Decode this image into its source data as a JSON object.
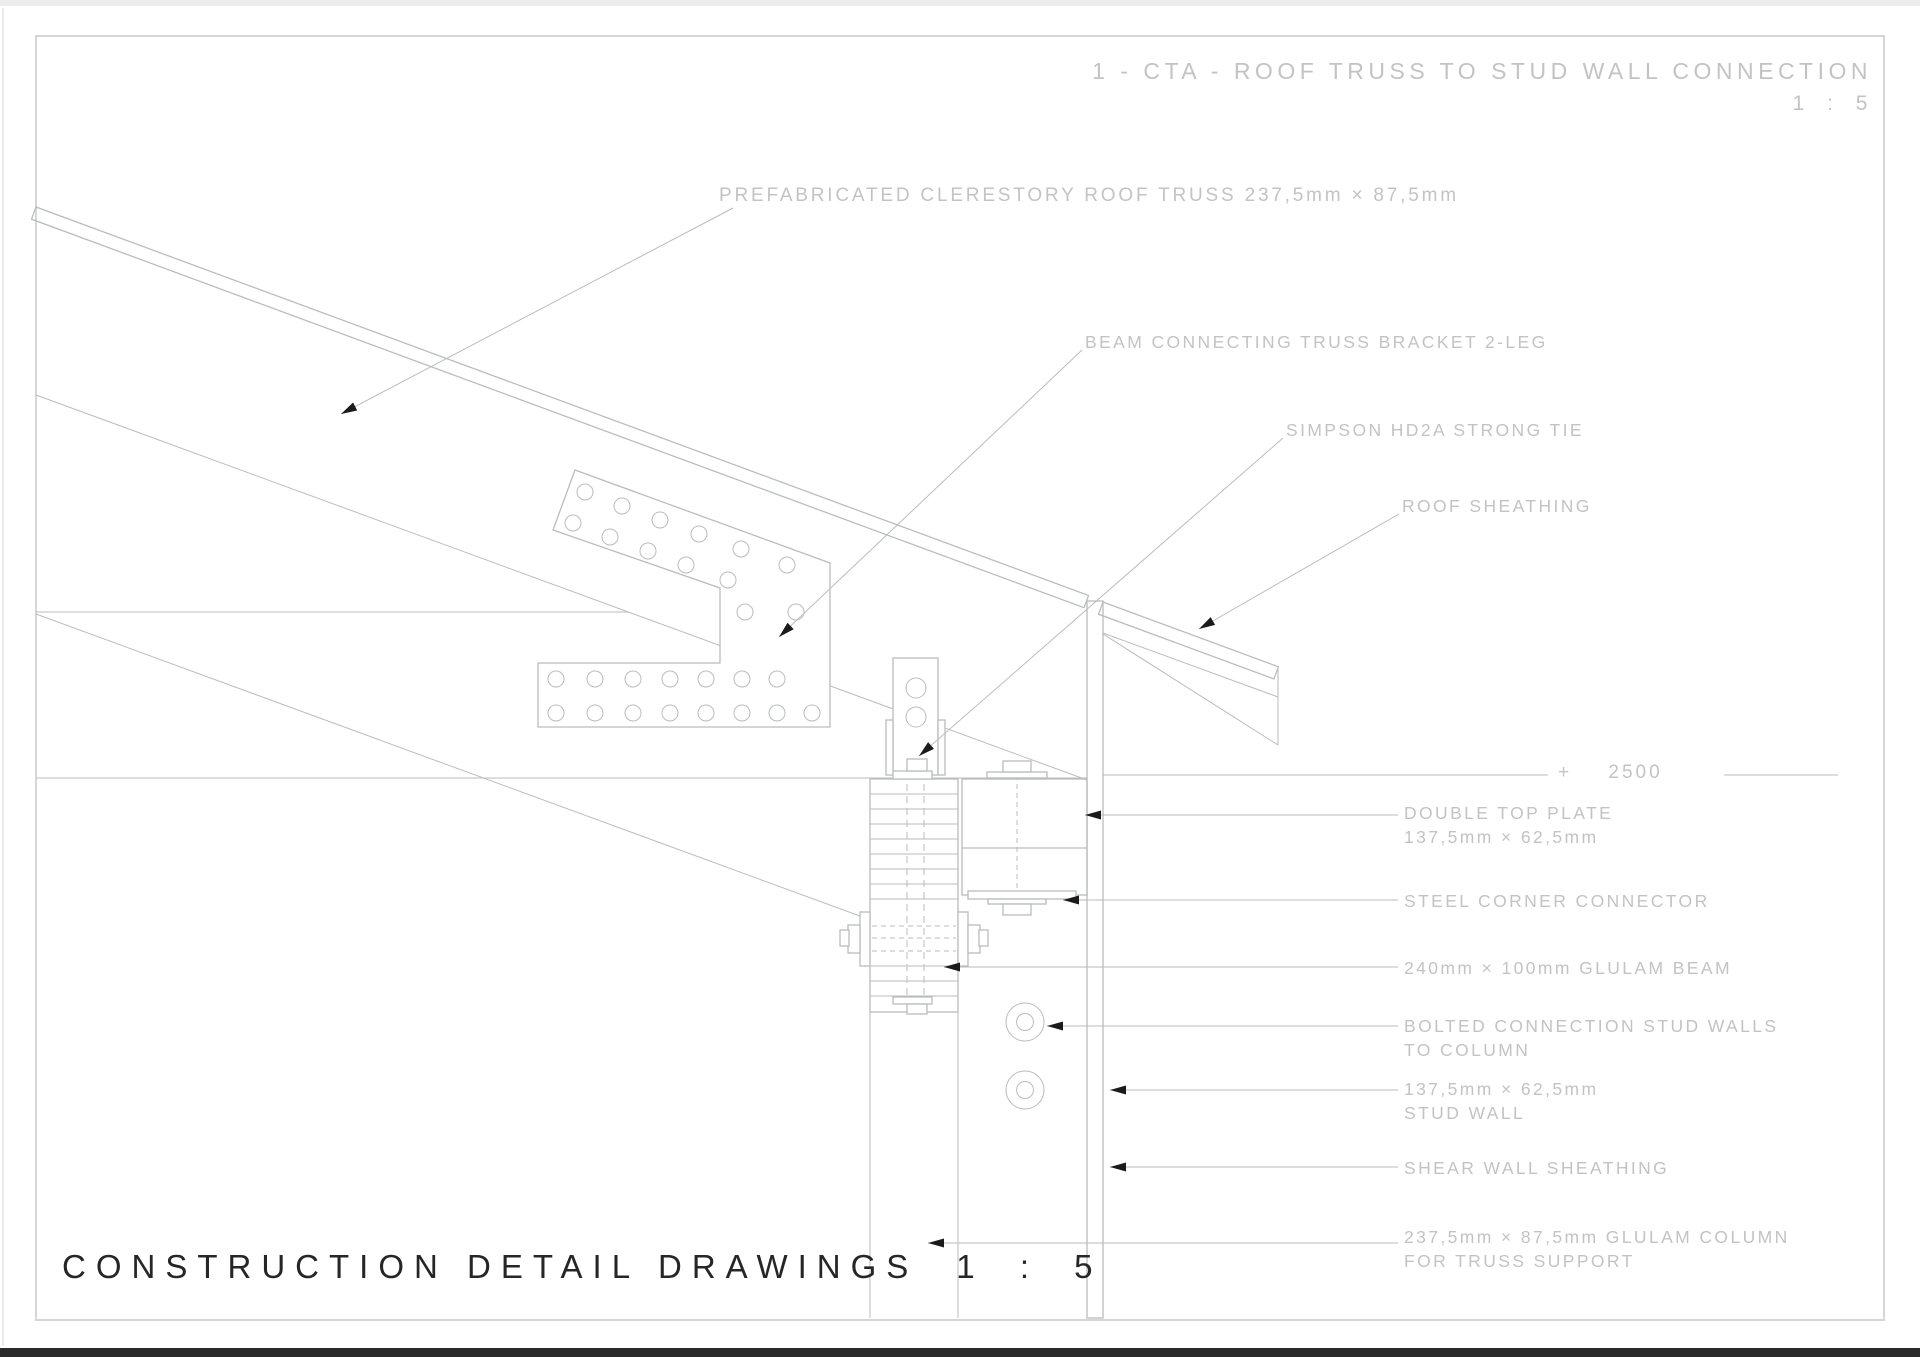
{
  "header": {
    "title": "1 - CTA - ROOF TRUSS TO STUD WALL CONNECTION",
    "scale": "1 : 5"
  },
  "footer": {
    "title": "CONSTRUCTION DETAIL DRAWINGS",
    "scale": "1 : 5"
  },
  "level_mark": {
    "value": "+ 2500"
  },
  "callouts": {
    "prefab_truss": {
      "line1": "PREFABRICATED CLERESTORY ROOF TRUSS 237,5mm × 87,5mm"
    },
    "beam_bracket": {
      "line1": "BEAM CONNECTING TRUSS BRACKET 2-LEG"
    },
    "simpson_tie": {
      "line1": "SIMPSON HD2A STRONG TIE"
    },
    "roof_sheathing": {
      "line1": "ROOF SHEATHING"
    },
    "double_top_plate": {
      "line1": "DOUBLE TOP PLATE",
      "line2": "137,5mm × 62,5mm"
    },
    "steel_corner": {
      "line1": "STEEL CORNER CONNECTOR"
    },
    "glulam_beam": {
      "line1": "240mm × 100mm GLULAM BEAM"
    },
    "bolted_connection": {
      "line1": "BOLTED CONNECTION STUD WALLS",
      "line2": "TO COLUMN"
    },
    "stud_wall": {
      "line1": "137,5mm × 62,5mm",
      "line2": "STUD WALL"
    },
    "shear_wall_sheathing": {
      "line1": "SHEAR WALL SHEATHING"
    },
    "glulam_column": {
      "line1": "237,5mm × 87,5mm GLULAM COLUMN",
      "line2": "FOR TRUSS SUPPORT"
    }
  },
  "colors": {
    "line": "#b9bdbd",
    "hatch": "#c9cdcd",
    "text": "#c3c3c3",
    "dark_text": "#262626",
    "arrow": "#1b1b1b"
  }
}
